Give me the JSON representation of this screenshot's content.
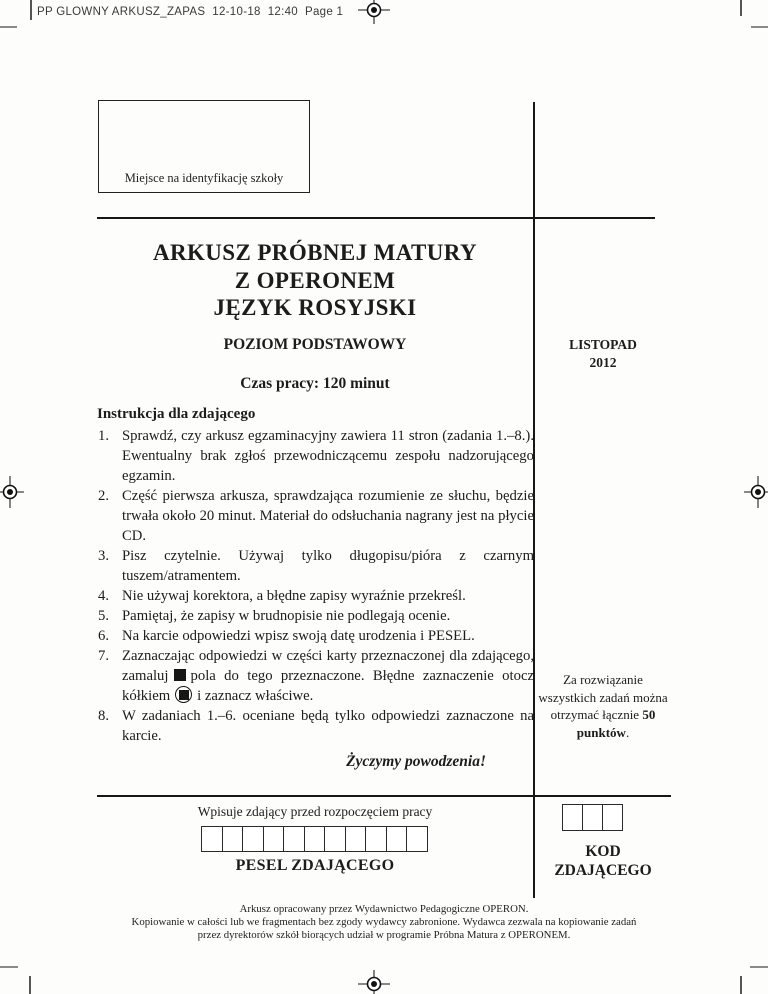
{
  "page": {
    "slug": "PP GLOWNY ARKUSZ_ZAPAS  12-10-18  12:40  Page 1"
  },
  "school_box": {
    "label": "Miejsce na identyfikację szkoły"
  },
  "header": {
    "title_line1": "ARKUSZ PRÓBNEJ MATURY",
    "title_line2": "Z OPERONEM",
    "title_line3": "JĘZYK ROSYJSKI",
    "level": "POZIOM PODSTAWOWY",
    "session_line1": "LISTOPAD",
    "session_line2": "2012",
    "time": "Czas pracy: 120 minut"
  },
  "instructions": {
    "heading": "Instrukcja dla zdającego",
    "items": [
      {
        "text": "Sprawdź, czy arkusz egzaminacyjny zawiera 11 stron (zadania 1.–8.). Ewentualny brak zgłoś przewodniczącemu zespołu nadzorującego egzamin."
      },
      {
        "text": "Część pierwsza arkusza, sprawdzająca rozumienie ze słuchu, będzie trwała około 20 minut. Materiał do odsłuchania nagrany jest na płycie CD."
      },
      {
        "text": "Pisz czytelnie. Używaj tylko długopisu/pióra z czarnym tuszem/atramentem."
      },
      {
        "text": "Nie używaj korektora, a błędne zapisy wyraźnie przekreśl."
      },
      {
        "text": "Pamiętaj, że zapisy w brudnopisie nie podlegają ocenie."
      },
      {
        "text": "Na karcie odpowiedzi wpisz swoją datę urodzenia i PESEL."
      },
      {
        "part1": "Zaznaczając odpowiedzi w części karty przeznaczonej dla zdającego, zamaluj",
        "part2": "pola do tego przeznaczone. Błędne zaznaczenie otocz kółkiem",
        "part3": "i zaznacz właściwe."
      },
      {
        "text": "W zadaniach 1.–6. oceniane będą tylko odpowiedzi zaznaczone na karcie."
      }
    ],
    "good_luck": "Życzymy powodzenia!"
  },
  "points_note": {
    "prefix": "Za rozwiązanie wszystkich zadań można otrzymać łącznie ",
    "bold": "50 punktów",
    "suffix": "."
  },
  "bottom": {
    "fill_in_label": "Wpisuje zdający przed rozpoczęciem pracy",
    "pesel_label": "PESEL ZDAJĄCEGO",
    "pesel_box_count": 11,
    "kod_box_count": 3,
    "kod_label_line1": "KOD",
    "kod_label_line2": "ZDAJĄCEGO"
  },
  "footer": {
    "line1": "Arkusz opracowany przez Wydawnictwo Pedagogiczne OPERON.",
    "line2": "Kopiowanie w całości lub we fragmentach bez zgody wydawcy zabronione. Wydawca zezwala na kopiowanie zadań",
    "line3": "przez dyrektorów szkół biorących udział w programie Próbna Matura z OPERONEM."
  },
  "icons": {
    "filled_square": "black filled square (answer mark)",
    "circled_square": "filled square inside circle (wrong answer mark)",
    "registration_target": "print registration crosshair target"
  },
  "colors": {
    "ink": "#1c1c1c",
    "paper": "#fdfdfc",
    "rule": "#171717"
  }
}
